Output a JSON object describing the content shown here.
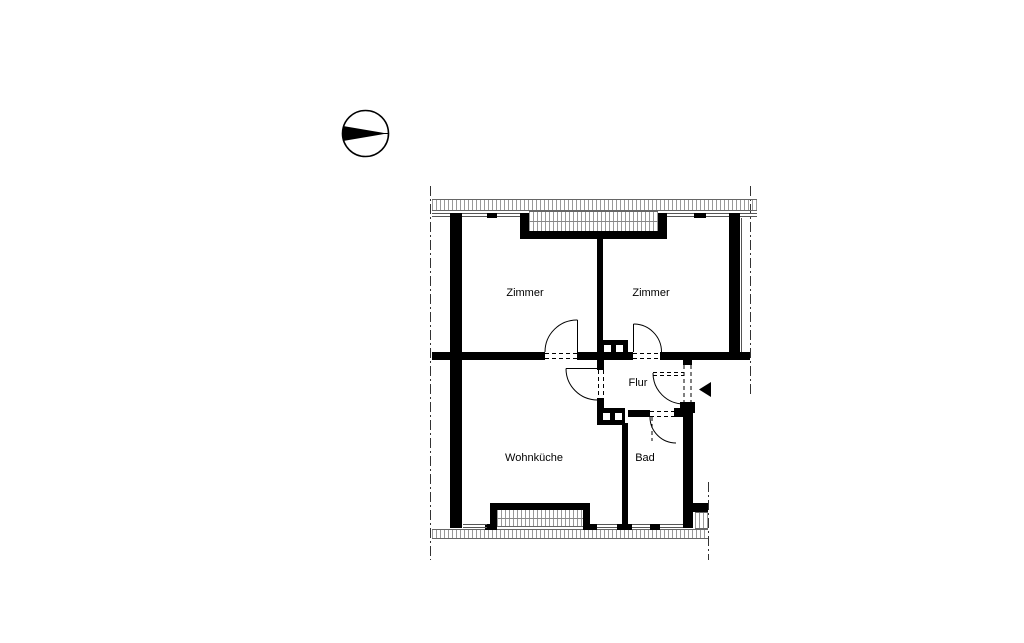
{
  "drawing": {
    "type": "floor-plan",
    "compass": {
      "icon": "north-arrow-icon",
      "direction": "pointing-right"
    },
    "rooms": [
      {
        "id": "zimmer-left",
        "label": "Zimmer"
      },
      {
        "id": "zimmer-right",
        "label": "Zimmer"
      },
      {
        "id": "flur",
        "label": "Flur"
      },
      {
        "id": "wohnkueche",
        "label": "Wohnküche"
      },
      {
        "id": "bad",
        "label": "Bad"
      }
    ],
    "symbols": [
      "entrance-arrow-icon",
      "door-swing-arc",
      "chimney-flue-block",
      "roof-edge-dashdot-line",
      "eaves-hatch-strip",
      "window-double-line"
    ],
    "colors": {
      "wall": "#000000",
      "thin_line": "#555555",
      "hatch": "#999999",
      "background": "#ffffff"
    }
  }
}
